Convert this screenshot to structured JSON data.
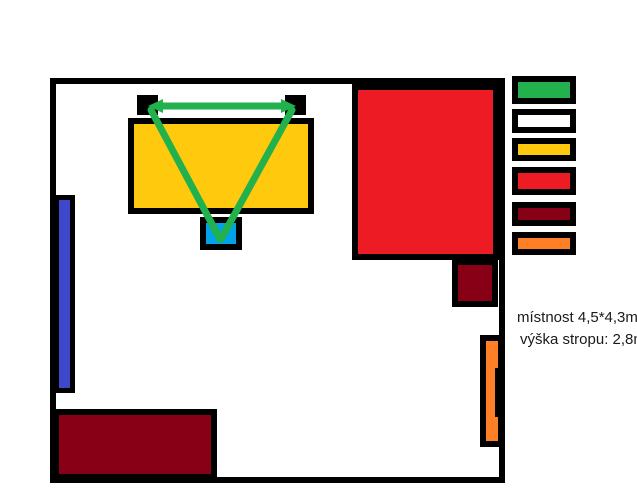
{
  "palette": {
    "black": "#000000",
    "white": "#ffffff",
    "green": "#22b14c",
    "yellow": "#ffc90e",
    "red": "#ed1c24",
    "dark_red": "#880015",
    "orange": "#ff7f27",
    "blue": "#3f48cc",
    "cyan": "#00a2e8"
  },
  "annotations": {
    "room_size": "místnost 4,5*4,3m",
    "ceiling_height": "výška stropu: 2,8m"
  },
  "legend": {
    "swatches": [
      {
        "name": "green",
        "color": "#22b14c"
      },
      {
        "name": "white",
        "color": "#ffffff"
      },
      {
        "name": "yellow",
        "color": "#ffc90e"
      },
      {
        "name": "red",
        "color": "#ed1c24"
      },
      {
        "name": "dark-red",
        "color": "#880015"
      },
      {
        "name": "orange",
        "color": "#ff7f27"
      }
    ]
  }
}
